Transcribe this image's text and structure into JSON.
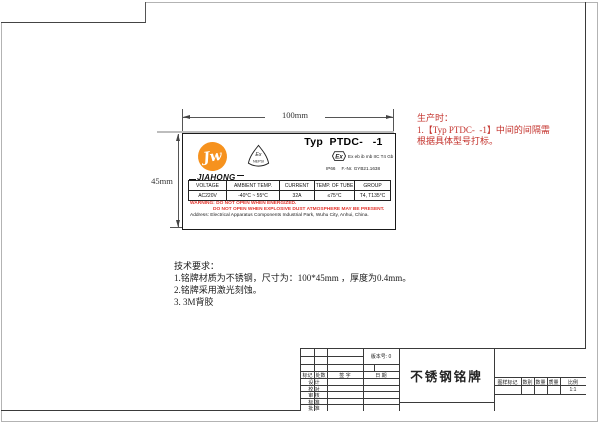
{
  "colors": {
    "accent_orange": "#f6921e",
    "production_note_red": "#c4332d",
    "warning_red": "#e3342c",
    "frame_line": "#3a3a3a"
  },
  "dimensions": {
    "width_label": "100mm",
    "height_label": "45mm"
  },
  "nameplate": {
    "model_title": "Typ  PTDC-   -1",
    "brand": "JIAHONG",
    "logo_glyph": "Jw",
    "nepsi_mark": {
      "line1": "Ex",
      "line2": "NEPSI"
    },
    "ex_symbol": "Ex",
    "ex_marking": "Ex eb ib mb IIC T4 Gb",
    "ip_rating": "IP66",
    "file_number": "F.-Nr. GYB21.1638",
    "spec_table": {
      "headers": [
        "VOLTAGE",
        "AMBIENT TEMP.",
        "CURRENT",
        "TEMP. OF TUBE",
        "GROUP"
      ],
      "values": [
        "AC220V",
        "-40°C ~ 55°C",
        "32A",
        "≤75°C",
        "T4, T135°C"
      ]
    },
    "warning_line1": "WARNING: DO NOT OPEN WHEN ENERGIZED.",
    "warning_line2": "DO NOT OPEN WHEN EXPLOSIVE DUST ATMOSPHERE MAY BE PRESENT.",
    "address": "Address: Electrical Apparatus Components Industrial Park, Wuhu City, Anhui, China."
  },
  "production_note": {
    "line1": "生产时：",
    "line2": "1.【Typ PTDC-  -1】中间的间隔需",
    "line3": "根据具体型号打标。"
  },
  "tech_requirements": {
    "title": "技术要求：",
    "item1": "1.铭牌材质为不锈钢，尺寸为：100*45mm ，厚度为0.4mm。",
    "item2": "2.铭牌采用激光刻蚀。",
    "item3": "3. 3M背胶"
  },
  "title_block": {
    "version": "版本号: 0",
    "drawing_title": "不锈钢铭牌",
    "rev_headers": [
      "标记",
      "处数",
      "签  字",
      "日  期"
    ],
    "row_labels": [
      "设 计",
      "校 对",
      "审 核",
      "标 准",
      "批 准"
    ],
    "right_headers": [
      "图样标记",
      "数别",
      "数量",
      "质量",
      "比例"
    ],
    "scale": "1:1"
  }
}
